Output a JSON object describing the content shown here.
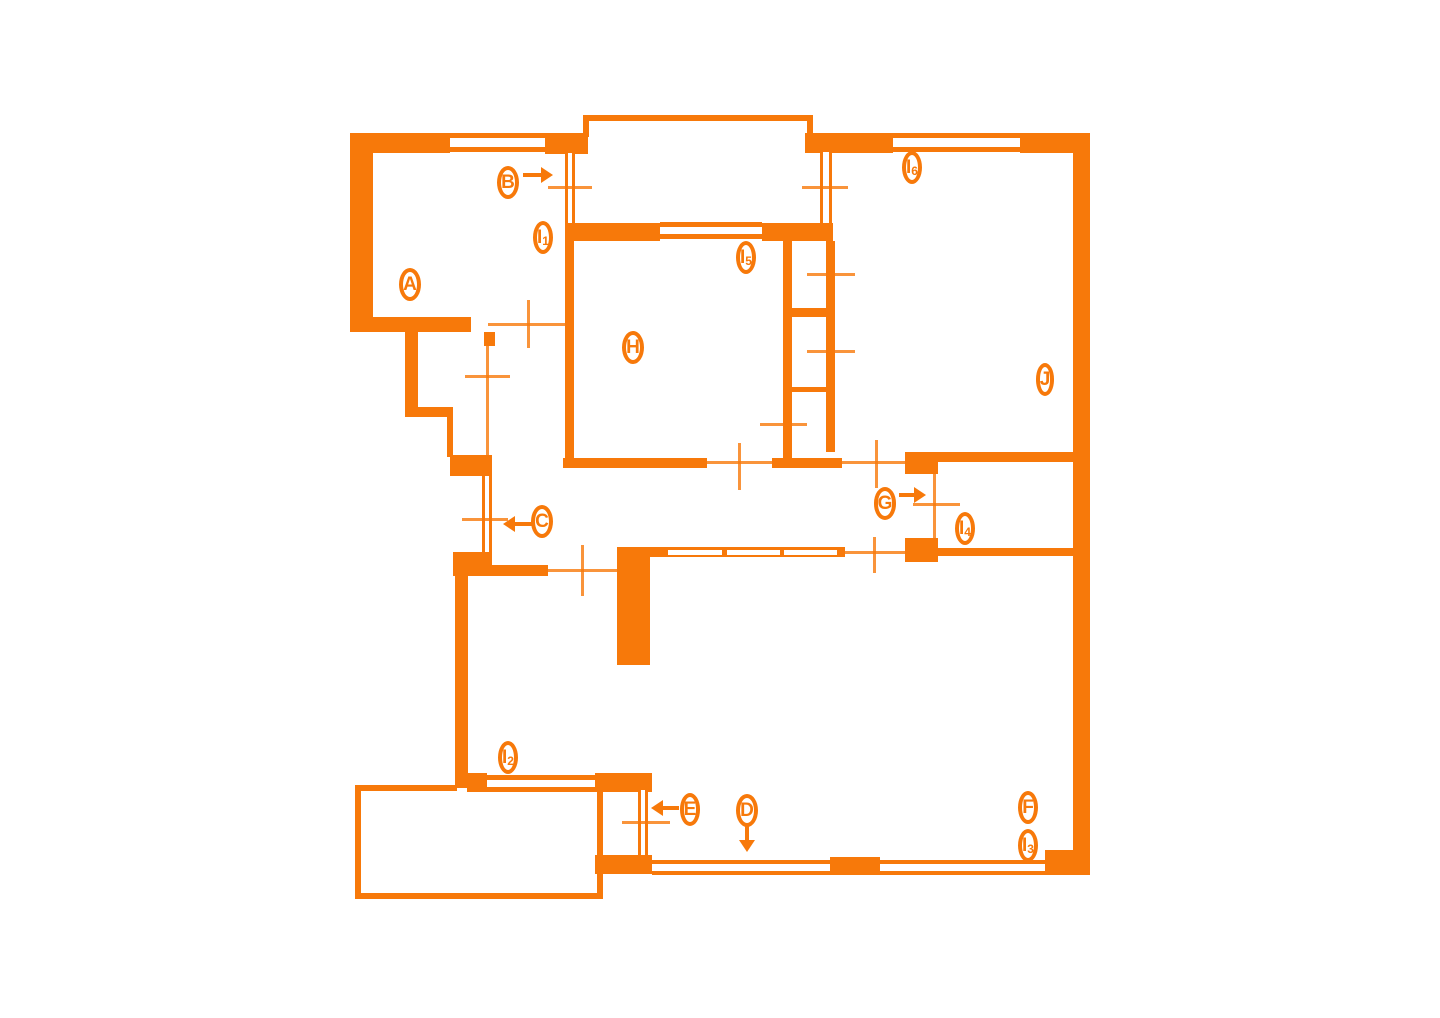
{
  "meta": {
    "type": "floor-plan-diagram"
  },
  "palette": {
    "wall": "#F7790A",
    "background": "#FFFFFF"
  },
  "canvas": {
    "width": 1440,
    "height": 1018
  },
  "plan": {
    "walls": [
      {
        "n": "outer-wall-left-a",
        "x": 350,
        "y": 135,
        "w": 23,
        "h": 196
      },
      {
        "n": "outer-wall-top-a",
        "x": 350,
        "y": 133,
        "w": 100,
        "h": 20
      },
      {
        "n": "top-block-balcony-left",
        "x": 545,
        "y": 133,
        "w": 43,
        "h": 21
      },
      {
        "n": "a-bottom-wall",
        "x": 350,
        "y": 317,
        "w": 121,
        "h": 15
      },
      {
        "n": "closet-left-wall",
        "x": 405,
        "y": 332,
        "w": 13,
        "h": 84
      },
      {
        "n": "closet-bottom-wall",
        "x": 405,
        "y": 407,
        "w": 48,
        "h": 10
      },
      {
        "n": "closet-right-stub",
        "x": 484,
        "y": 332,
        "w": 11,
        "h": 14
      },
      {
        "n": "left-connector-wall",
        "x": 447,
        "y": 417,
        "w": 6,
        "h": 40
      },
      {
        "n": "c-door-upper-block",
        "x": 450,
        "y": 455,
        "w": 42,
        "h": 21
      },
      {
        "n": "c-door-lower-block",
        "x": 453,
        "y": 552,
        "w": 39,
        "h": 24
      },
      {
        "n": "hall-wall",
        "x": 490,
        "y": 565,
        "w": 58,
        "h": 11
      },
      {
        "n": "center-pillar",
        "x": 617,
        "y": 547,
        "w": 33,
        "h": 118
      },
      {
        "n": "i2-left-wall",
        "x": 455,
        "y": 565,
        "w": 13,
        "h": 223
      },
      {
        "n": "i2-bottom-left-block",
        "x": 467,
        "y": 773,
        "w": 20,
        "h": 19
      },
      {
        "n": "i2-bottom-right-block",
        "x": 595,
        "y": 773,
        "w": 57,
        "h": 19
      },
      {
        "n": "e-door-bottom-block",
        "x": 595,
        "y": 855,
        "w": 57,
        "h": 19
      },
      {
        "n": "bottom-mid-block",
        "x": 830,
        "y": 857,
        "w": 50,
        "h": 18
      },
      {
        "n": "bottom-right-corner",
        "x": 1045,
        "y": 850,
        "w": 45,
        "h": 25
      },
      {
        "n": "outer-wall-right",
        "x": 1073,
        "y": 133,
        "w": 17,
        "h": 735
      },
      {
        "n": "top-block-j-left",
        "x": 805,
        "y": 133,
        "w": 88,
        "h": 20
      },
      {
        "n": "top-block-j-right",
        "x": 1020,
        "y": 133,
        "w": 70,
        "h": 20
      },
      {
        "n": "h-top-wall-left",
        "x": 565,
        "y": 223,
        "w": 95,
        "h": 18
      },
      {
        "n": "h-top-wall-right",
        "x": 762,
        "y": 223,
        "w": 71,
        "h": 18
      },
      {
        "n": "h-left-wall",
        "x": 565,
        "y": 241,
        "w": 9,
        "h": 221
      },
      {
        "n": "h-bottom-wall",
        "x": 563,
        "y": 458,
        "w": 144,
        "h": 10
      },
      {
        "n": "shaft-bottom-wall",
        "x": 772,
        "y": 458,
        "w": 70,
        "h": 10
      },
      {
        "n": "shaft-left-wall",
        "x": 783,
        "y": 241,
        "w": 9,
        "h": 217
      },
      {
        "n": "shaft-right-wall",
        "x": 826,
        "y": 241,
        "w": 9,
        "h": 211
      },
      {
        "n": "shaft-divider-1",
        "x": 792,
        "y": 308,
        "w": 34,
        "h": 9
      },
      {
        "n": "shaft-divider-2",
        "x": 792,
        "y": 387,
        "w": 34,
        "h": 5
      },
      {
        "n": "j-door-jamb-top",
        "x": 905,
        "y": 452,
        "w": 33,
        "h": 22
      },
      {
        "n": "j-door-jamb-bottom",
        "x": 905,
        "y": 538,
        "w": 33,
        "h": 24
      },
      {
        "n": "j-bottom-wall",
        "x": 938,
        "y": 452,
        "w": 135,
        "h": 10
      },
      {
        "n": "i4-closet-bottom-wall",
        "x": 938,
        "y": 548,
        "w": 135,
        "h": 8
      },
      {
        "n": "balcony-railing-top",
        "x": 583,
        "y": 115,
        "w": 230,
        "h": 6
      },
      {
        "n": "balcony-railing-left",
        "x": 583,
        "y": 115,
        "w": 6,
        "h": 22
      },
      {
        "n": "balcony-railing-right",
        "x": 807,
        "y": 115,
        "w": 6,
        "h": 22
      },
      {
        "n": "terrace-railing-top",
        "x": 357,
        "y": 785,
        "w": 100,
        "h": 6
      },
      {
        "n": "terrace-railing-left",
        "x": 355,
        "y": 785,
        "w": 6,
        "h": 114
      },
      {
        "n": "terrace-railing-bottom",
        "x": 355,
        "y": 893,
        "w": 248,
        "h": 6
      },
      {
        "n": "terrace-railing-right",
        "x": 597,
        "y": 790,
        "w": 6,
        "h": 103
      },
      {
        "n": "livingroom-window-band",
        "x": 650,
        "y": 547,
        "w": 195,
        "h": 10
      }
    ],
    "windows": [
      {
        "n": "window-a-top",
        "x": 450,
        "y": 133,
        "w": 95,
        "h": 19,
        "o": "h",
        "t": 5
      },
      {
        "n": "window-i6",
        "x": 893,
        "y": 133,
        "w": 127,
        "h": 19,
        "o": "h",
        "t": 5
      },
      {
        "n": "window-i5",
        "x": 660,
        "y": 222,
        "w": 102,
        "h": 17,
        "o": "h",
        "t": 5
      },
      {
        "n": "window-b",
        "x": 565,
        "y": 153,
        "w": 10,
        "h": 70,
        "o": "v",
        "t": 3
      },
      {
        "n": "window-j-balcony",
        "x": 820,
        "y": 152,
        "w": 12,
        "h": 71,
        "o": "v",
        "t": 3
      },
      {
        "n": "window-c",
        "x": 482,
        "y": 476,
        "w": 10,
        "h": 76,
        "o": "v",
        "t": 3
      },
      {
        "n": "window-i2",
        "x": 487,
        "y": 775,
        "w": 108,
        "h": 17,
        "o": "h",
        "t": 5
      },
      {
        "n": "door-e",
        "x": 638,
        "y": 790,
        "w": 10,
        "h": 65,
        "o": "v",
        "t": 3
      },
      {
        "n": "window-d-left",
        "x": 652,
        "y": 860,
        "w": 178,
        "h": 15,
        "o": "h",
        "t": 4
      },
      {
        "n": "window-d-right",
        "x": 880,
        "y": 860,
        "w": 165,
        "h": 15,
        "o": "h",
        "t": 4
      }
    ],
    "panes": [
      {
        "n": "lr-window-pane-1",
        "x": 668,
        "y": 550,
        "w": 54,
        "h": 5
      },
      {
        "n": "lr-window-pane-2",
        "x": 727,
        "y": 550,
        "w": 53,
        "h": 5
      },
      {
        "n": "lr-window-pane-3",
        "x": 784,
        "y": 550,
        "w": 53,
        "h": 5
      }
    ],
    "dims": [
      {
        "n": "dim-window-b",
        "x": 548,
        "y": 186,
        "w": 44,
        "h": 3
      },
      {
        "n": "dim-window-j",
        "x": 802,
        "y": 186,
        "w": 46,
        "h": 3
      },
      {
        "n": "dim-a-door-h",
        "x": 488,
        "y": 323,
        "w": 82,
        "h": 3
      },
      {
        "n": "dim-a-door-v",
        "x": 527,
        "y": 300,
        "w": 3,
        "h": 48
      },
      {
        "n": "dim-closet-door-v",
        "x": 486,
        "y": 346,
        "w": 3,
        "h": 109
      },
      {
        "n": "dim-closet-door-h",
        "x": 465,
        "y": 375,
        "w": 45,
        "h": 3
      },
      {
        "n": "dim-c-door",
        "x": 462,
        "y": 518,
        "w": 46,
        "h": 3
      },
      {
        "n": "dim-hall-door-h",
        "x": 548,
        "y": 569,
        "w": 69,
        "h": 3
      },
      {
        "n": "dim-hall-door-v",
        "x": 581,
        "y": 545,
        "w": 3,
        "h": 51
      },
      {
        "n": "dim-h-door-h",
        "x": 707,
        "y": 461,
        "w": 66,
        "h": 3
      },
      {
        "n": "dim-h-door-v",
        "x": 738,
        "y": 443,
        "w": 3,
        "h": 47
      },
      {
        "n": "dim-passage-h",
        "x": 842,
        "y": 461,
        "w": 63,
        "h": 3
      },
      {
        "n": "dim-passage-v",
        "x": 875,
        "y": 440,
        "w": 3,
        "h": 48
      },
      {
        "n": "dim-lr-opening-h",
        "x": 845,
        "y": 551,
        "w": 60,
        "h": 3
      },
      {
        "n": "dim-lr-opening-v",
        "x": 873,
        "y": 537,
        "w": 3,
        "h": 36
      },
      {
        "n": "dim-i4-door-v",
        "x": 933,
        "y": 474,
        "w": 3,
        "h": 64
      },
      {
        "n": "dim-i4-door-h",
        "x": 913,
        "y": 503,
        "w": 47,
        "h": 3
      },
      {
        "n": "dim-shaft-1",
        "x": 807,
        "y": 273,
        "w": 48,
        "h": 3
      },
      {
        "n": "dim-shaft-2",
        "x": 807,
        "y": 350,
        "w": 48,
        "h": 3
      },
      {
        "n": "dim-shaft-3",
        "x": 760,
        "y": 423,
        "w": 47,
        "h": 3
      },
      {
        "n": "dim-e-door",
        "x": 622,
        "y": 821,
        "w": 48,
        "h": 3
      }
    ],
    "labels": [
      {
        "id": "A",
        "t": "A",
        "s": "",
        "x": 410,
        "y": 284
      },
      {
        "id": "B",
        "t": "B",
        "s": "",
        "x": 508,
        "y": 182,
        "arrow": {
          "dir": "right",
          "x": 523,
          "y": 175,
          "len": 18
        }
      },
      {
        "id": "I1",
        "t": "I",
        "s": "1",
        "x": 543,
        "y": 237
      },
      {
        "id": "I5",
        "t": "I",
        "s": "5",
        "x": 746,
        "y": 257
      },
      {
        "id": "I6",
        "t": "I",
        "s": "6",
        "x": 912,
        "y": 167
      },
      {
        "id": "H",
        "t": "H",
        "s": "",
        "x": 633,
        "y": 347
      },
      {
        "id": "J",
        "t": "J",
        "s": "",
        "x": 1045,
        "y": 379
      },
      {
        "id": "C",
        "t": "C",
        "s": "",
        "x": 542,
        "y": 521,
        "arrow": {
          "dir": "left",
          "x": 503,
          "y": 524,
          "len": 18
        }
      },
      {
        "id": "G",
        "t": "G",
        "s": "",
        "x": 885,
        "y": 503,
        "arrow": {
          "dir": "right",
          "x": 899,
          "y": 495,
          "len": 15
        }
      },
      {
        "id": "I4",
        "t": "I",
        "s": "4",
        "x": 965,
        "y": 528
      },
      {
        "id": "I2",
        "t": "I",
        "s": "2",
        "x": 508,
        "y": 757
      },
      {
        "id": "E",
        "t": "E",
        "s": "",
        "x": 690,
        "y": 809,
        "arrow": {
          "dir": "left",
          "x": 651,
          "y": 808,
          "len": 16
        }
      },
      {
        "id": "D",
        "t": "D",
        "s": "",
        "x": 747,
        "y": 810,
        "arrow": {
          "dir": "down",
          "x": 747,
          "y": 824,
          "len": 16
        }
      },
      {
        "id": "F",
        "t": "F",
        "s": "",
        "x": 1028,
        "y": 807
      },
      {
        "id": "I3",
        "t": "I",
        "s": "3",
        "x": 1028,
        "y": 845
      }
    ]
  }
}
